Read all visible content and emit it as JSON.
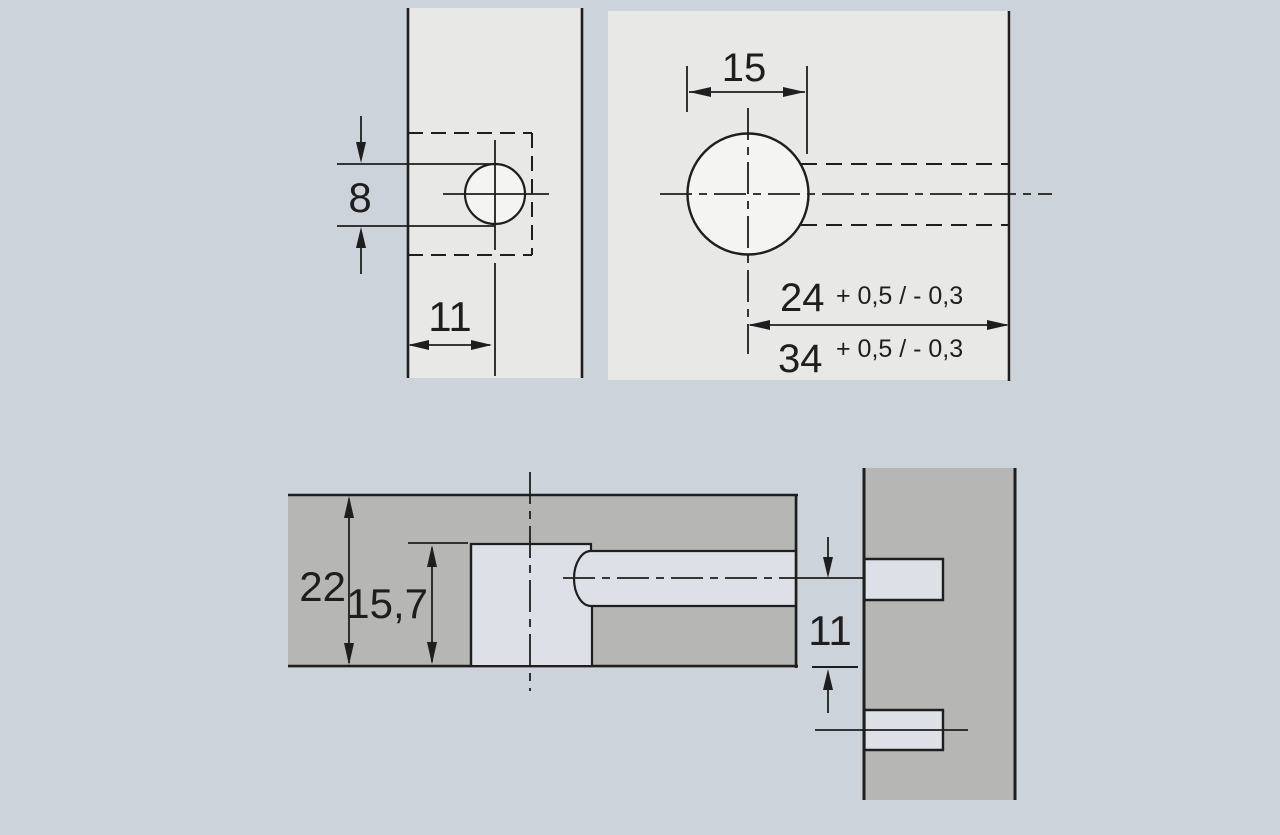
{
  "drawing": {
    "title": "furniture-fitting-drilling-diagram",
    "colors": {
      "background": "#cdd3da",
      "panel_light": "#e8e8e6",
      "panel_dark": "#b6b7b4",
      "hole_fill": "#f4f4f2",
      "cut_fill": "#dde1e7",
      "line": "#1e1e1e"
    },
    "views": {
      "front_edge": {
        "hole_diameter_label": "8",
        "edge_distance_label": "11"
      },
      "face": {
        "hole_diameter_label": "15",
        "depth_a_label": "24",
        "depth_a_tolerance": "+ 0,5 / - 0,3",
        "depth_b_label": "34",
        "depth_b_tolerance": "+ 0,5 / - 0,3"
      },
      "section": {
        "panel_thickness_label": "22",
        "bore_height_label": "15,7",
        "center_offset_label": "11"
      }
    }
  }
}
